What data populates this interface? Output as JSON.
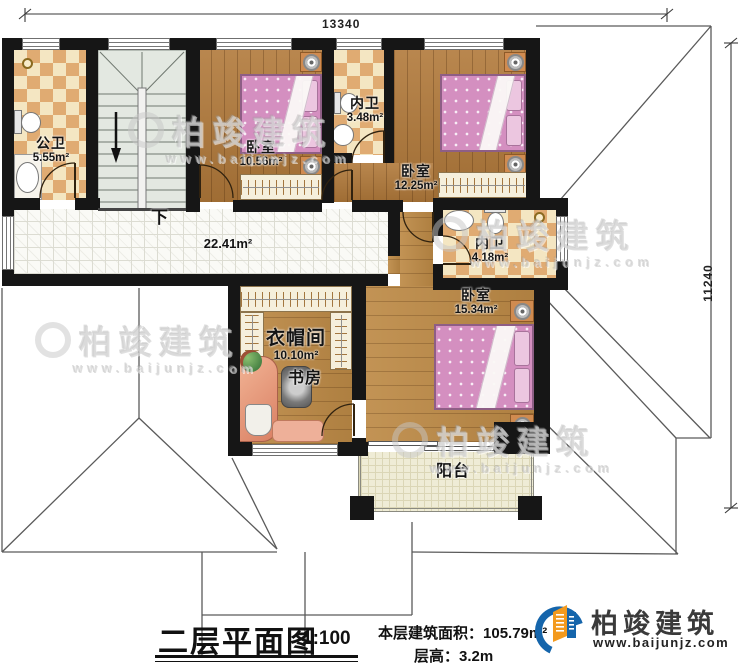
{
  "dimensions": {
    "top": "13340",
    "right": "11240"
  },
  "rooms": {
    "gongwei": {
      "label": "公卫",
      "area": "5.55m²"
    },
    "bedroom1": {
      "label": "卧室",
      "area": "10.56m²"
    },
    "neiwei1": {
      "label": "内卫",
      "area": "3.48m²"
    },
    "bedroom2": {
      "label": "卧室",
      "area": "12.25m²"
    },
    "neiwei2": {
      "label": "内卫",
      "area": "4.18m²"
    },
    "bedroom3": {
      "label": "卧室",
      "area": "15.34m²"
    },
    "cloakroom": {
      "label": "衣帽间",
      "area": "10.10m²"
    },
    "study": {
      "label": "书房"
    },
    "balcony": {
      "label": "阳台"
    },
    "hallway": {
      "area": "22.41m²"
    },
    "stairs": {
      "label": "下"
    }
  },
  "title": {
    "name": "二层平面图",
    "scale": "1:100",
    "floor_area_label": "本层建筑面积：",
    "floor_area_value": "105.79m²",
    "floor_height_label": "层高：",
    "floor_height_value": "3.2m"
  },
  "logo": {
    "name": "柏竣建筑",
    "website": "www.baijunjz.com"
  },
  "watermark": {
    "text": "柏竣建筑",
    "website": "www.baijunjz.com"
  },
  "colors": {
    "wall": "#161616",
    "tile_dark": "#e0ab72",
    "tile_light": "#f4e6c2",
    "wood": "#b1793a",
    "bed_pink": "#d48fc0",
    "brand_blue": "#1565ab",
    "brand_orange": "#f39a1e"
  }
}
